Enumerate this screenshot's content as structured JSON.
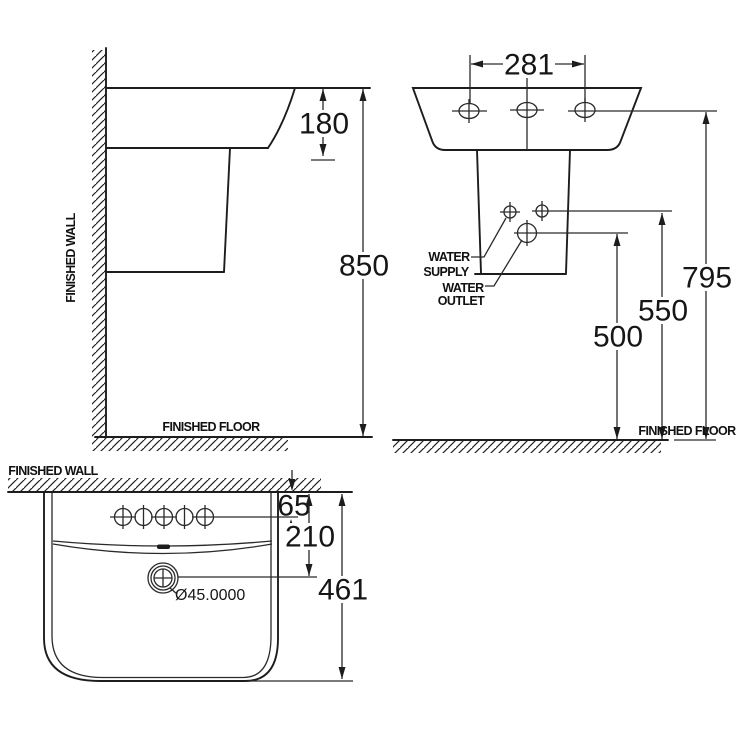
{
  "meta": {
    "background": "#ffffff",
    "line_color": "#1d1d1d",
    "drawing_type": "basin installation dimension drawing"
  },
  "side_view": {
    "wall_label": "FINISHED WALL",
    "floor_label": "FINISHED FLOOR",
    "dims": {
      "basin_depth": "180",
      "rim_height": "850"
    }
  },
  "front_view": {
    "floor_label": "FINISHED FLOOR",
    "water_supply": {
      "line1": "WATER",
      "line2": "SUPPLY"
    },
    "water_outlet": {
      "line1": "WATER",
      "line2": "OUTLET"
    },
    "dims": {
      "hole_spacing": "281",
      "rim_height": "795",
      "supply_height": "550",
      "outlet_height": "500"
    }
  },
  "plan_view": {
    "wall_label": "FINISHED WALL",
    "drain_diameter": "Ø45.0000",
    "dims": {
      "wall_to_holes": "65",
      "wall_to_drain": "210",
      "overall_width": "461"
    }
  }
}
